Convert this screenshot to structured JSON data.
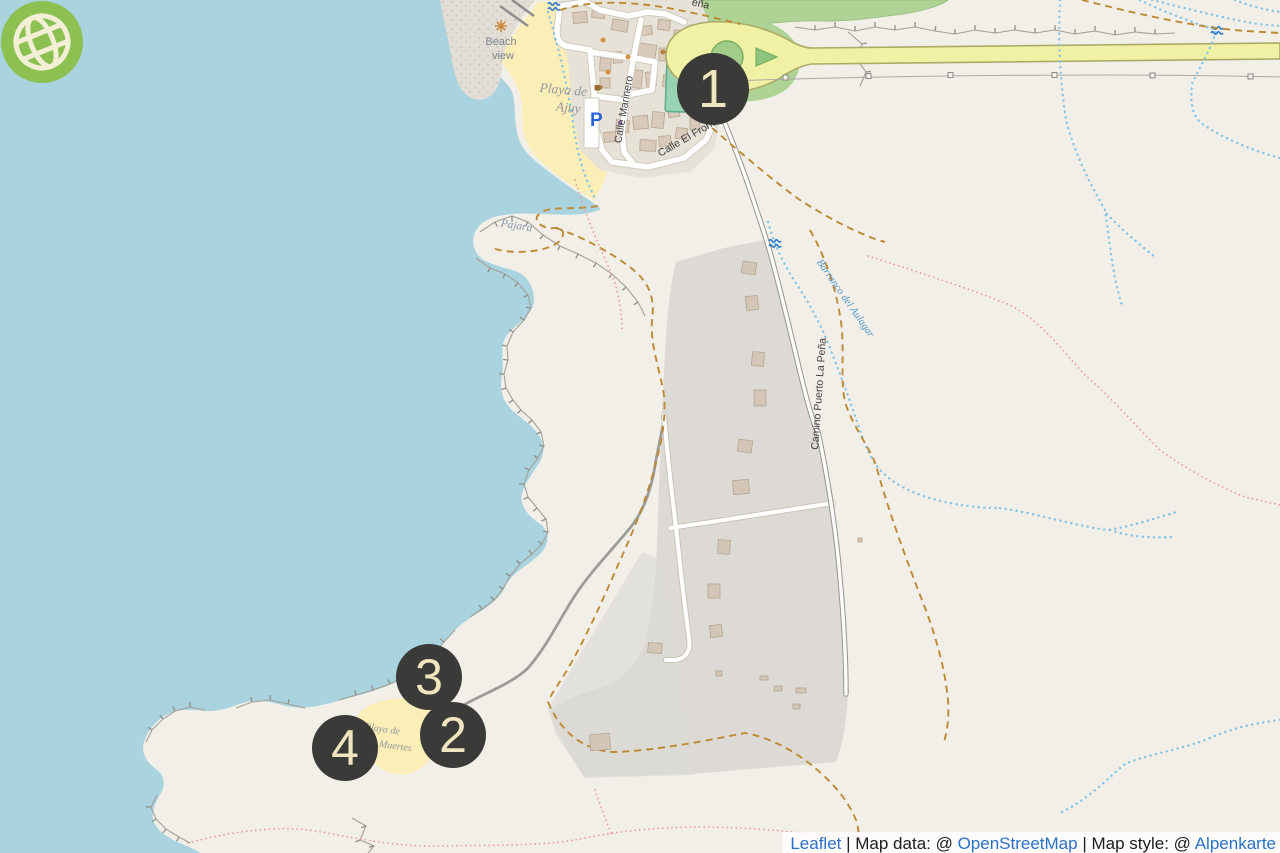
{
  "map": {
    "markers": [
      {
        "number": "1"
      },
      {
        "number": "2"
      },
      {
        "number": "3"
      },
      {
        "number": "4"
      }
    ],
    "labels": {
      "beach_view_line1": "Beach",
      "beach_view_line2": "view",
      "playa_ajuy_line1": "Playa de",
      "playa_ajuy_line2": "Ajuy",
      "playa_muertes_line1": "Playa de",
      "playa_muertes_line2": "los Muertes",
      "pajara": "Pájara",
      "calle_marinero": "Calle Marinero",
      "calle_el_fronton": "Calle El Fronton",
      "camino_puerto": "Camino Puerto La Peña",
      "barranco": "Barranco del Aulagar",
      "partial_top_street": "eña",
      "parking": "P"
    },
    "icons": {
      "globe_logo": "globe-logo-icon",
      "viewpoint": "viewpoint-icon",
      "waterfall": "waterfall-icon",
      "parking": "parking-icon",
      "cafe": "cafe-icon"
    },
    "colors": {
      "sea": "#aad3e0",
      "land": "#f2efe9",
      "sand": "#fceeb7",
      "road_yellow": "#f1f1a6",
      "grass": "#aed394",
      "pitch": "#9ad2b4",
      "quarry": "#dbd9d5",
      "marker_bg": "#3a3a38",
      "marker_text": "#f0e5be",
      "stream": "#85c3e3",
      "path_dashed": "#bd8a33",
      "path_dotted": "#ec9898",
      "logo_green": "#8cc152",
      "logo_cream": "#f3eed6",
      "link_blue": "#2a70c8"
    }
  },
  "attribution": {
    "leaflet": "Leaflet",
    "sep1": " | ",
    "map_data_label": "Map data: @ ",
    "openstreetmap": "OpenStreetMap",
    "sep2": " | ",
    "map_style_label": "Map style: @ ",
    "alpenkarte": "Alpenkarte"
  }
}
